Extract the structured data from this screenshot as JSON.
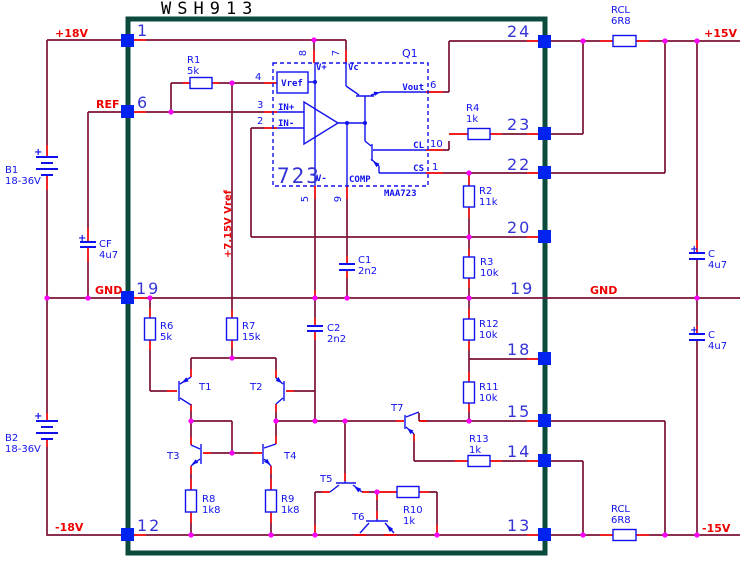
{
  "title": "WSH913",
  "symbols": {
    "plus": "+"
  },
  "nets": {
    "plus18": "+18V",
    "ref": "REF",
    "gnd_left": "GND",
    "minus18": "-18V",
    "plus15": "+15V",
    "gnd_right": "GND",
    "minus15": "-15V",
    "vref_rail": "+7.15V Vref"
  },
  "pins": {
    "p1": "1",
    "p6": "6",
    "p19_left": "19",
    "p12": "12",
    "p24": "24",
    "p23": "23",
    "p22": "22",
    "p20": "20",
    "p19_right": "19",
    "p18": "18",
    "p15": "15",
    "p14": "14",
    "p13": "13"
  },
  "ic": {
    "designator": "Q1",
    "big_label": "723",
    "part": "MAA723",
    "names": {
      "vref": "Vref",
      "vplus": "V+",
      "vc": "Vc",
      "vminus": "V-",
      "comp": "COMP",
      "in_plus": "IN+",
      "in_minus": "IN-",
      "vout": "Vout",
      "cl": "CL",
      "cs": "CS"
    },
    "numbers": {
      "vref": "4",
      "vplus": "8",
      "vc": "7",
      "vminus": "5",
      "comp": "9",
      "in_plus": "3",
      "in_minus": "2",
      "vout": "6",
      "cl": "10",
      "cs": "1"
    }
  },
  "components": {
    "R1": {
      "ref": "R1",
      "value": "5k"
    },
    "R2": {
      "ref": "R2",
      "value": "11k"
    },
    "R3": {
      "ref": "R3",
      "value": "10k"
    },
    "R4": {
      "ref": "R4",
      "value": "1k"
    },
    "R6": {
      "ref": "R6",
      "value": "5k"
    },
    "R7": {
      "ref": "R7",
      "value": "15k"
    },
    "R8": {
      "ref": "R8",
      "value": "1k8"
    },
    "R9": {
      "ref": "R9",
      "value": "1k8"
    },
    "R10": {
      "ref": "R10",
      "value": "1k"
    },
    "R11": {
      "ref": "R11",
      "value": "10k"
    },
    "R12": {
      "ref": "R12",
      "value": "10k"
    },
    "R13": {
      "ref": "R13",
      "value": "1k"
    },
    "RCL_top": {
      "ref": "RCL",
      "value": "6R8"
    },
    "RCL_bottom": {
      "ref": "RCL",
      "value": "6R8"
    },
    "C1": {
      "ref": "C1",
      "value": "2n2"
    },
    "C2": {
      "ref": "C2",
      "value": "2n2"
    },
    "CF": {
      "ref": "CF",
      "value": "4u7"
    },
    "C_top": {
      "ref": "C",
      "value": "4u7"
    },
    "C_bottom": {
      "ref": "C",
      "value": "4u7"
    },
    "B1": {
      "ref": "B1",
      "value": "18-36V"
    },
    "B2": {
      "ref": "B2",
      "value": "18-36V"
    },
    "T1": {
      "ref": "T1"
    },
    "T2": {
      "ref": "T2"
    },
    "T3": {
      "ref": "T3"
    },
    "T4": {
      "ref": "T4"
    },
    "T5": {
      "ref": "T5"
    },
    "T6": {
      "ref": "T6"
    },
    "T7": {
      "ref": "T7"
    }
  }
}
